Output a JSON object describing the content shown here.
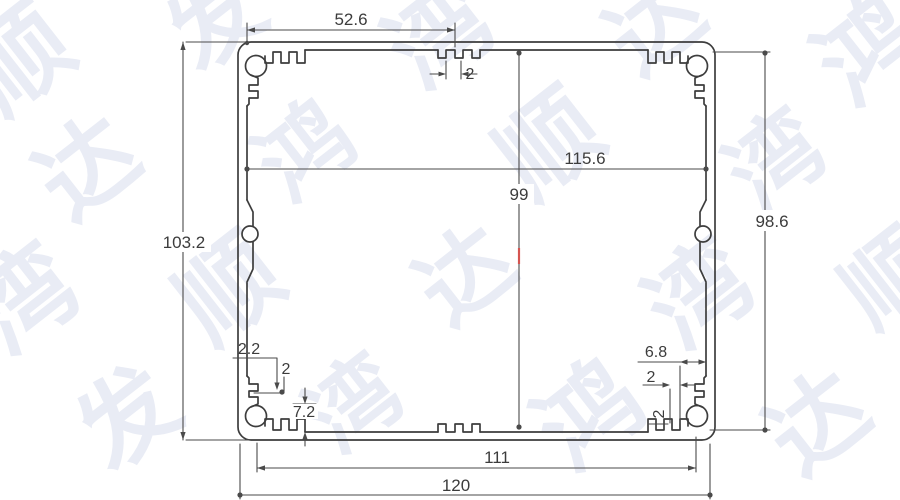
{
  "watermark": {
    "chars": [
      "顺",
      "达",
      "发",
      "鸿",
      "湾"
    ]
  },
  "dimensions": {
    "top_width": "52.6",
    "top_tooth": "2",
    "inner_width": "115.6",
    "inner_height": "99",
    "overall_height": "103.2",
    "right_inner_height": "98.6",
    "bl_tooth_width": "2.2",
    "bl_tooth": "2",
    "bl_boss_height": "7.2",
    "br_boss_width": "6.8",
    "br_tooth": "2",
    "br_tooth_vertical": "2",
    "bottom_screw_span": "111",
    "overall_width": "120"
  }
}
